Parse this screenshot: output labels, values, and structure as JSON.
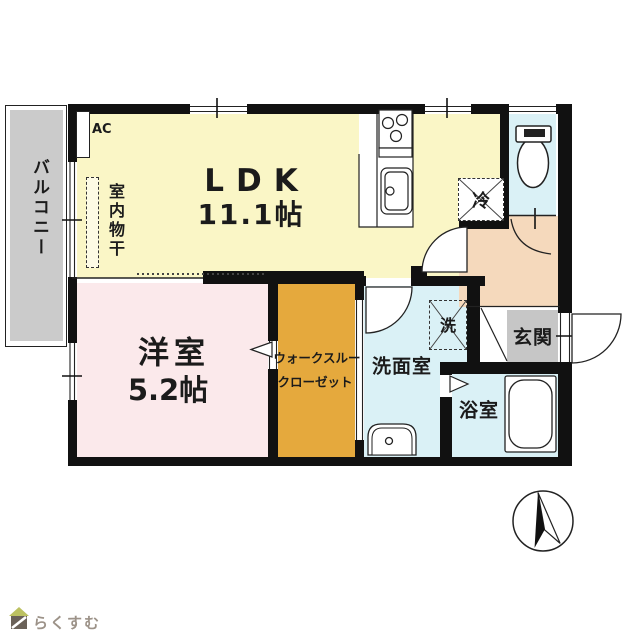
{
  "floorplan": {
    "balcony": {
      "label": "バルコニー"
    },
    "ldk": {
      "name": "LDK",
      "size": "11.1帖"
    },
    "ac": {
      "label": "AC"
    },
    "indoor_drying": {
      "label": "室内物干"
    },
    "fridge": {
      "label": "冷"
    },
    "western_room": {
      "name": "洋室",
      "size": "5.2帖"
    },
    "walk_through_closet": {
      "line1": "ウォークスルー",
      "line2": "クローゼット"
    },
    "washroom": {
      "label": "洗面室"
    },
    "washer": {
      "label": "洗"
    },
    "entrance": {
      "label": "玄関"
    },
    "bathroom": {
      "label": "浴室"
    },
    "colors": {
      "ldk": "#faf6c6",
      "western_room": "#fbe9eb",
      "closet": "#e5a93d",
      "wet_area": "#daf1f6",
      "hallway": "#f5d9bc",
      "entrance": "#c6c6c6",
      "balcony": "#cbcbcb",
      "wall": "#111111",
      "logo_roof": "#bcc161",
      "logo_body": "#6a6158",
      "brand_text": "#9c9288"
    }
  },
  "footer": {
    "brand": "らくすむ"
  }
}
